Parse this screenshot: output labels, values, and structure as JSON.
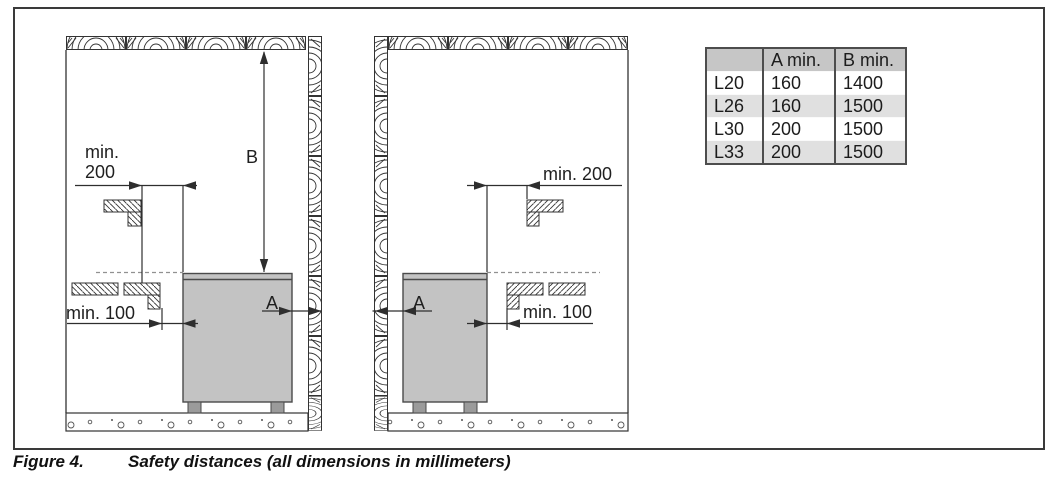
{
  "figure": {
    "caption_label": "Figure 4.",
    "caption_text": "Safety distances (all dimensions in millimeters)"
  },
  "diagram_left": {
    "min200_word": "min.",
    "min200_value": "200",
    "b_label": "B",
    "min100_label": "min. 100",
    "a_label": "A"
  },
  "diagram_right": {
    "min200_label": "min. 200",
    "min100_label": "min. 100",
    "a_label": "A"
  },
  "table": {
    "headers": [
      "",
      "A min.",
      "B min."
    ],
    "rows": [
      {
        "model": "L20",
        "a_min": "160",
        "b_min": "1400"
      },
      {
        "model": "L26",
        "a_min": "160",
        "b_min": "1500"
      },
      {
        "model": "L30",
        "a_min": "200",
        "b_min": "1500"
      },
      {
        "model": "L33",
        "a_min": "200",
        "b_min": "1500"
      }
    ]
  },
  "colors": {
    "line": "#2e2e2e",
    "heater_body": "#c3c3c3",
    "heater_feet": "#9b9b9b",
    "dashed_line": "#919191",
    "table_border": "#4d4d4d",
    "table_header_bg": "#c6c6c6",
    "table_alt_row_bg": "#e0e0e0"
  }
}
